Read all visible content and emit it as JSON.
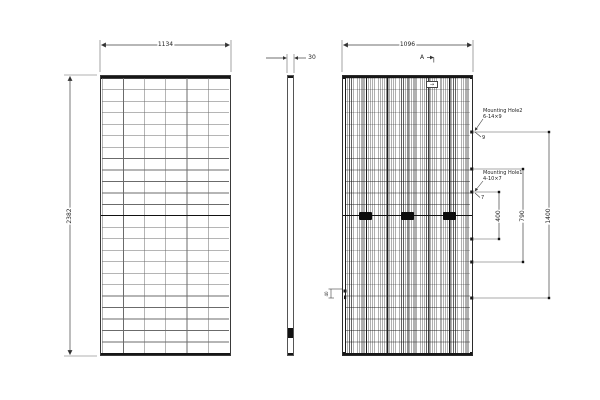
{
  "front_view": {
    "width_dim": "1134",
    "height_dim": "2382"
  },
  "side_view": {
    "thickness_dim": "30"
  },
  "rear_view": {
    "width_dim": "1096",
    "section_label": "A",
    "mounting_hole2_name": "Mounting Hole2",
    "mounting_hole2_spec": "6-14×9",
    "mounting_hole2_callout": "9",
    "mounting_hole1_name": "Mounting Hole1",
    "mounting_hole1_spec": "4-10×7",
    "mounting_hole1_callout": "7",
    "dim_inner": "400",
    "dim_middle": "790",
    "dim_outer": "1400",
    "grounding_dim": "40"
  },
  "colors": {
    "line": "#3f3f3f",
    "frame": "#161616",
    "background": "#ffffff"
  }
}
